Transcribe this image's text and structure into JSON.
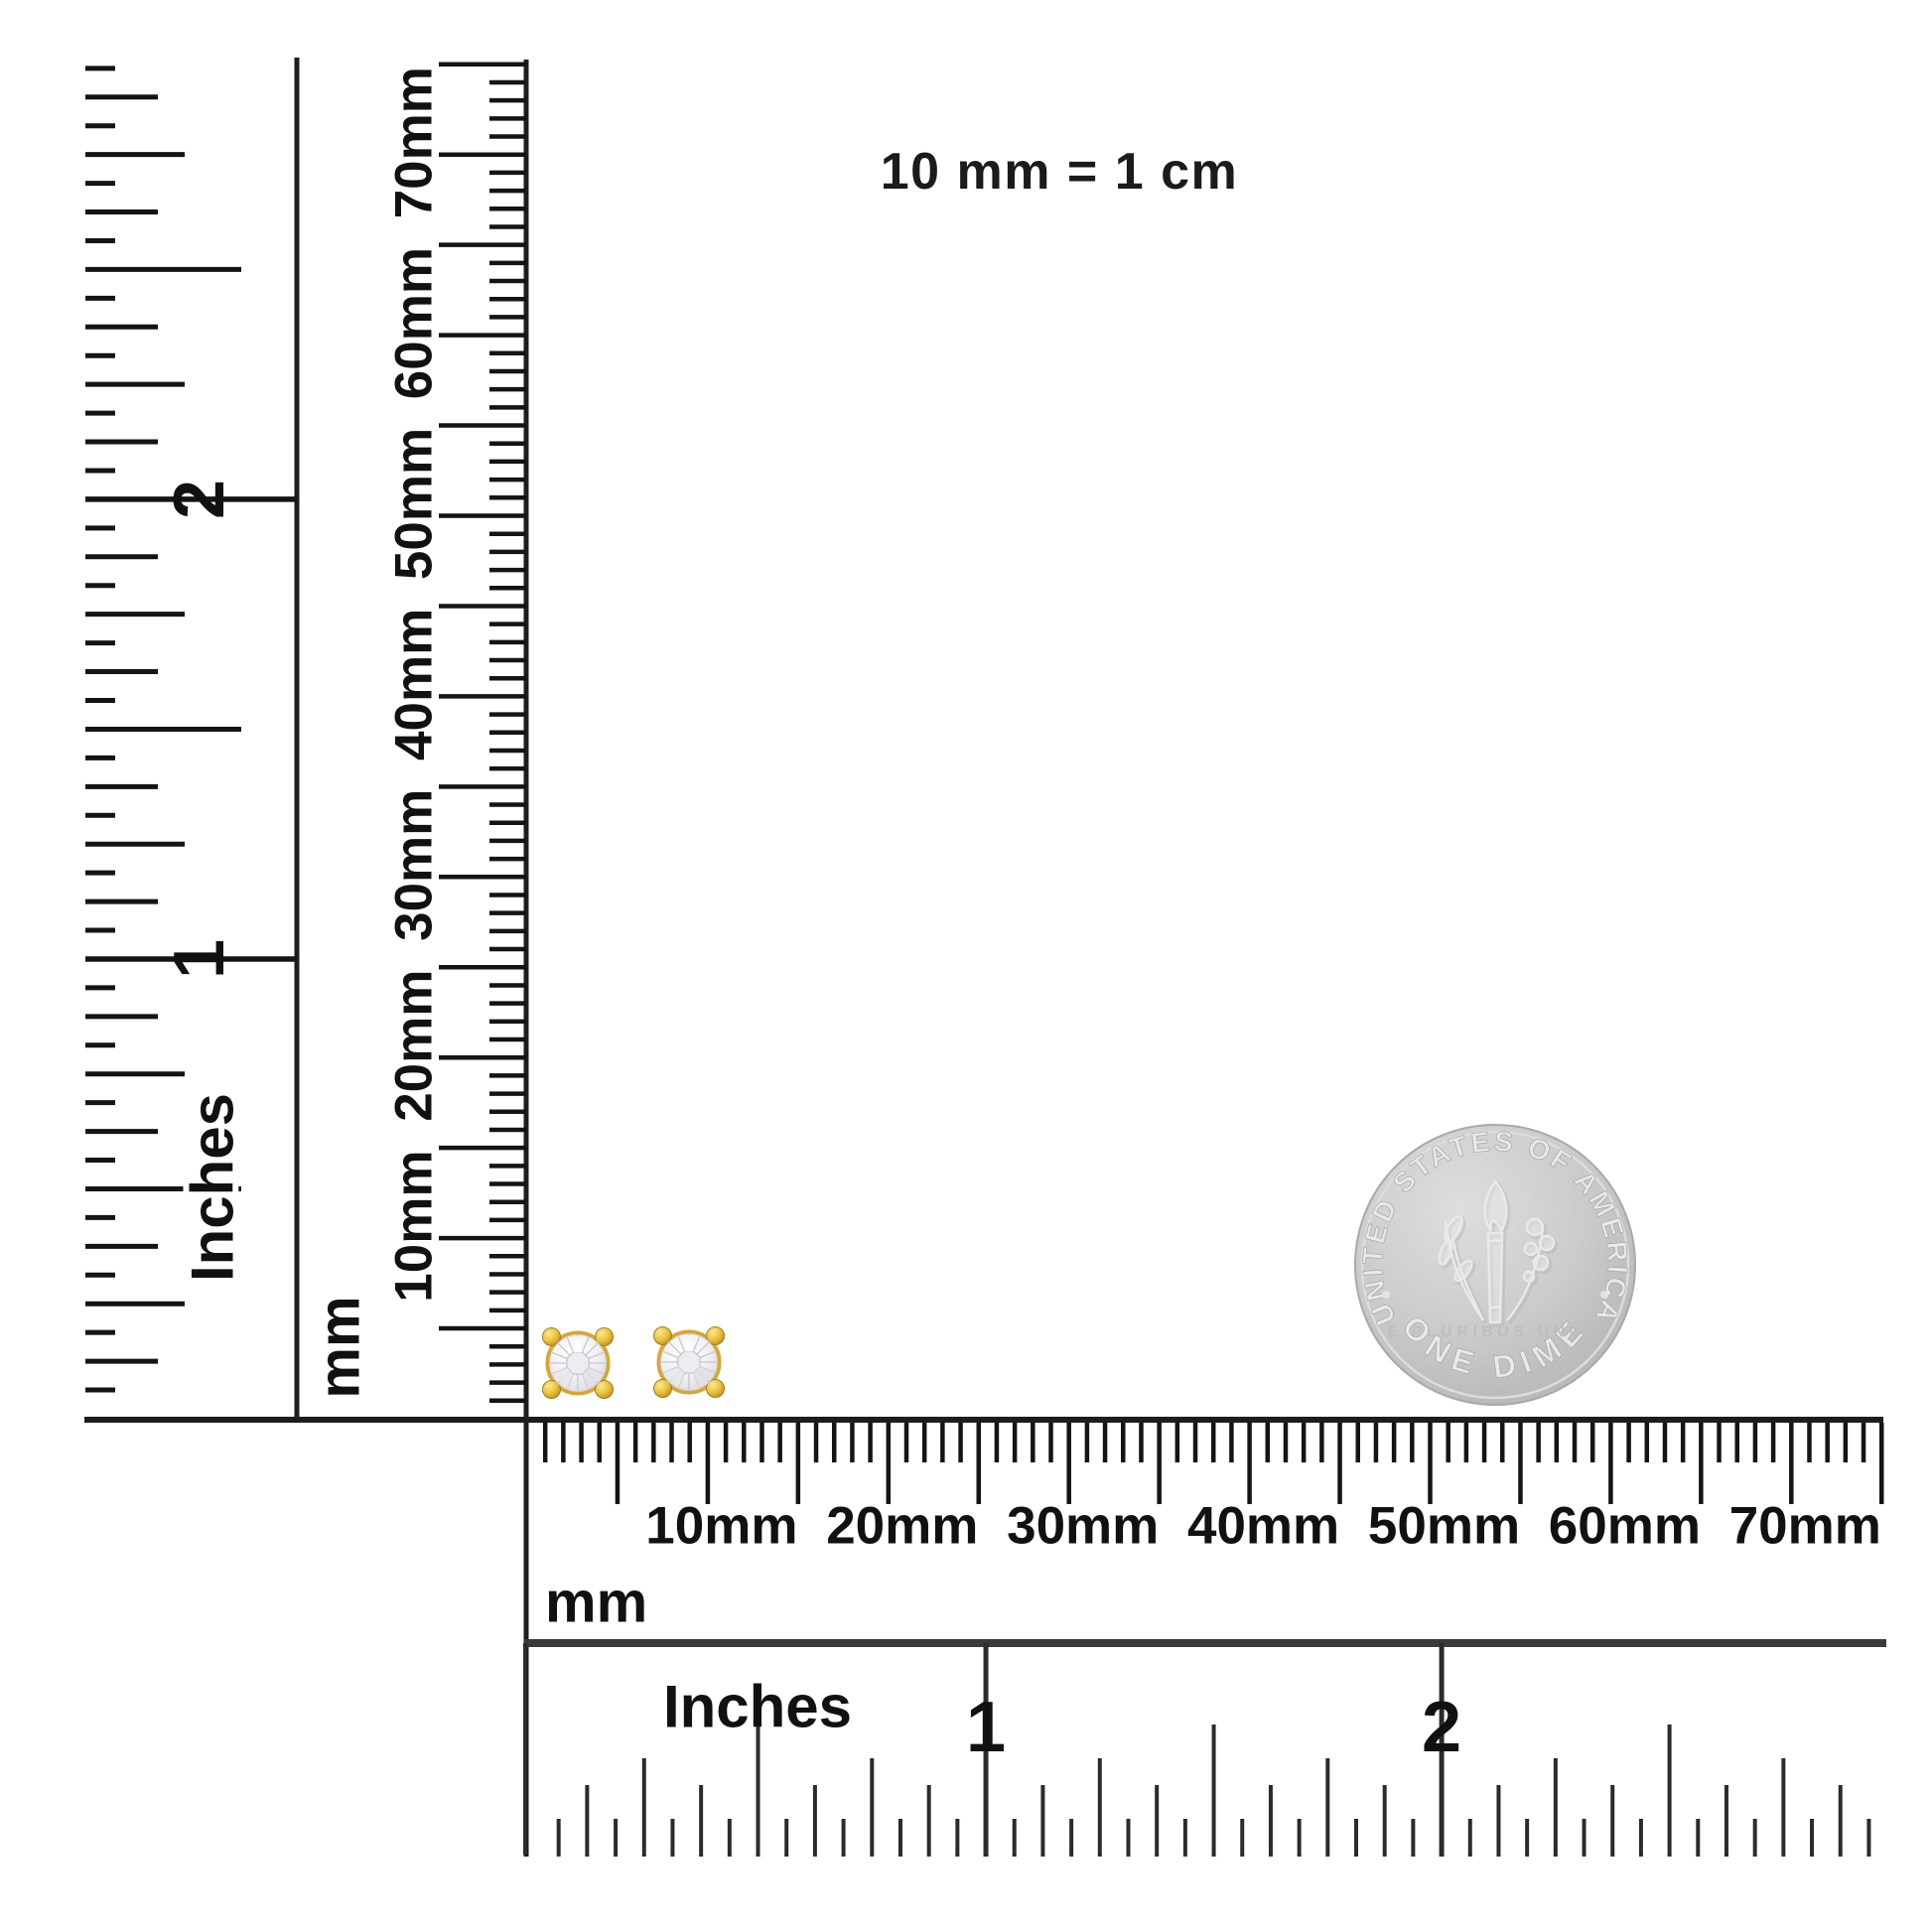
{
  "scale_note": "10 mm = 1 cm",
  "rulers": {
    "vertical_inches": {
      "unit_label": "Inches",
      "numbers": [
        "1",
        "2"
      ]
    },
    "vertical_mm": {
      "unit_label": "mm",
      "tick_labels": [
        "10mm",
        "20mm",
        "30mm",
        "40mm",
        "50mm",
        "60mm",
        "70mm"
      ]
    },
    "horizontal_mm": {
      "unit_label": "mm",
      "tick_labels": [
        "10mm",
        "20mm",
        "30mm",
        "40mm",
        "50mm",
        "60mm",
        "70mm"
      ]
    },
    "horizontal_inches": {
      "unit_label": "Inches",
      "numbers": [
        "1",
        "2"
      ]
    }
  },
  "coin": {
    "top_text": "UNITED STATES OF AMERICA",
    "motto": "E PLURIBUS UNUM",
    "bottom_text": "ONE DIME"
  },
  "earrings": {
    "count": 2
  },
  "colors": {
    "ink": "#161616",
    "ruler_edge": "#2a2a2a",
    "gold": "#d9a62e",
    "gold_light": "#fbe98f",
    "diamond": "#f1f1f4",
    "coin_silver": "#cbcbcb"
  }
}
